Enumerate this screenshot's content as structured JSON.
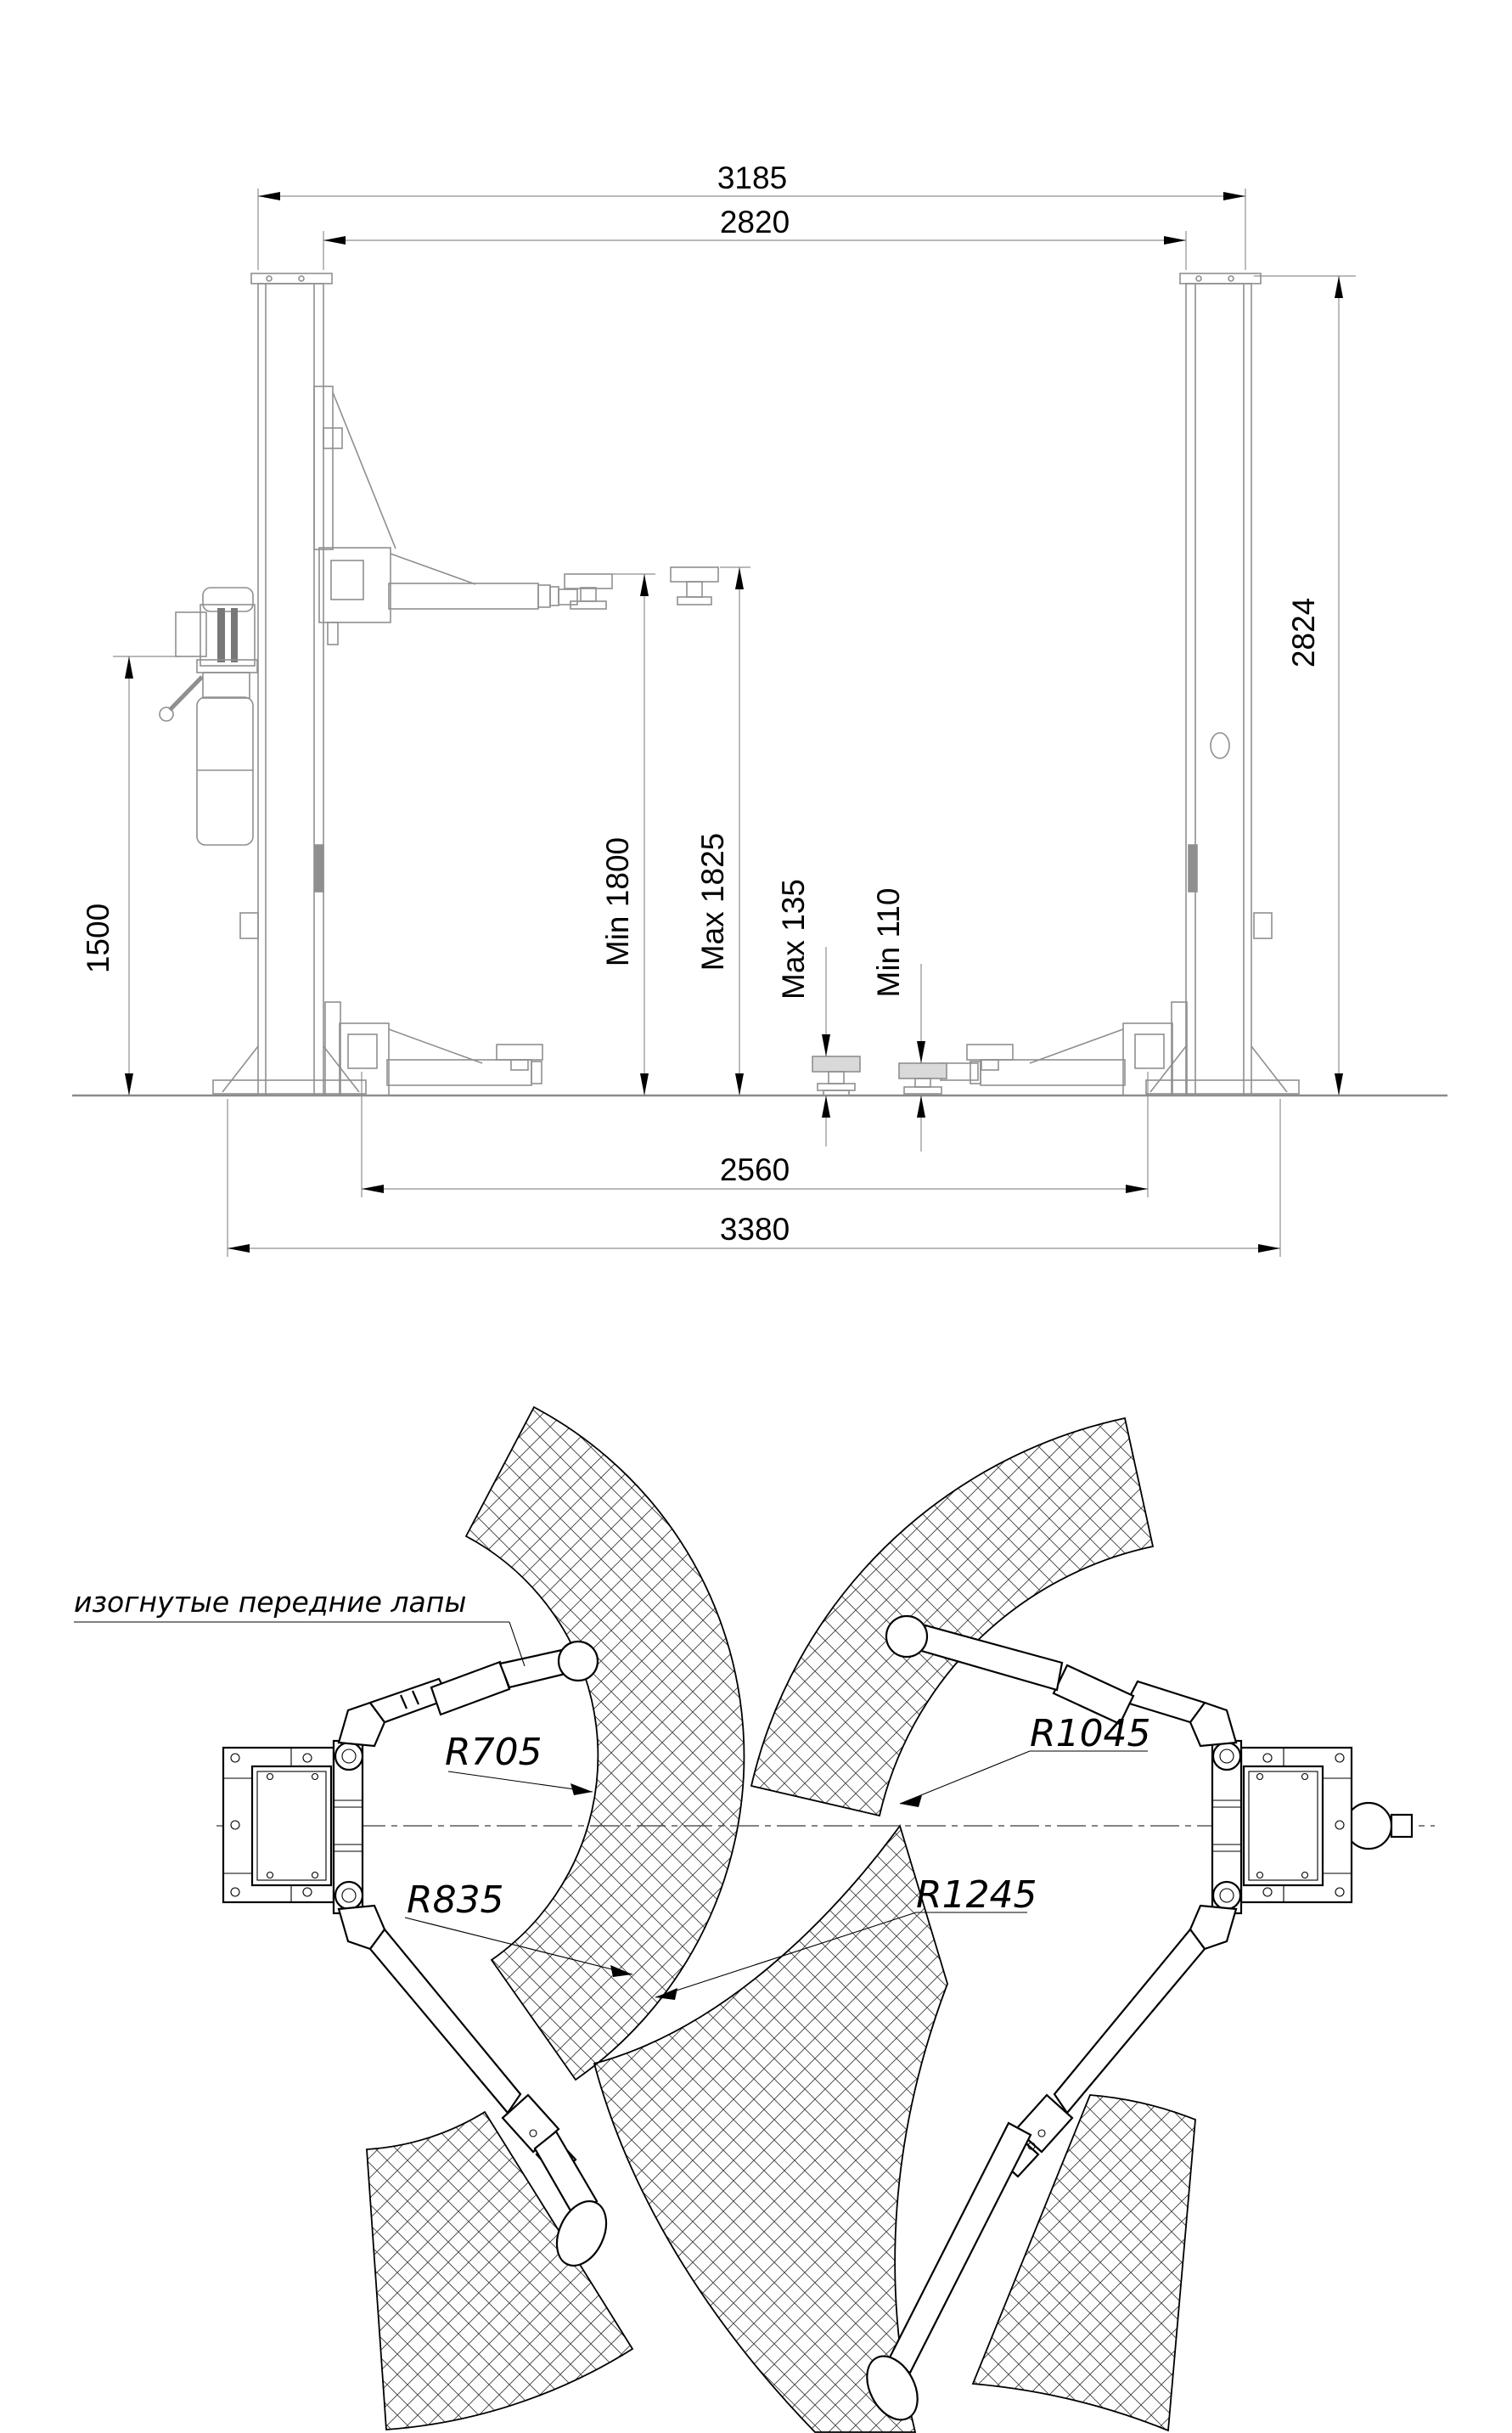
{
  "front_view": {
    "dim_overall_width_top": "3185",
    "dim_inner_width_top": "2820",
    "dim_column_height": "2824",
    "dim_power_unit_height": "1500",
    "dim_lift_height_min": "Min 1800",
    "dim_lift_height_max": "Max 1825",
    "dim_pad_height_max": "Max 135",
    "dim_pad_height_min": "Min 110",
    "dim_inner_width_bottom": "2560",
    "dim_overall_width_bottom": "3380"
  },
  "plan_view": {
    "note_front_arms": "изогнутые передние лапы",
    "radius_front_arm_min": "R705",
    "radius_front_arm_max": "R835",
    "radius_rear_arm_min": "R1045",
    "radius_rear_arm_max": "R1245"
  },
  "colors": {
    "line_gray": "#8f8f8f",
    "line_black": "#000000",
    "background": "#ffffff"
  }
}
